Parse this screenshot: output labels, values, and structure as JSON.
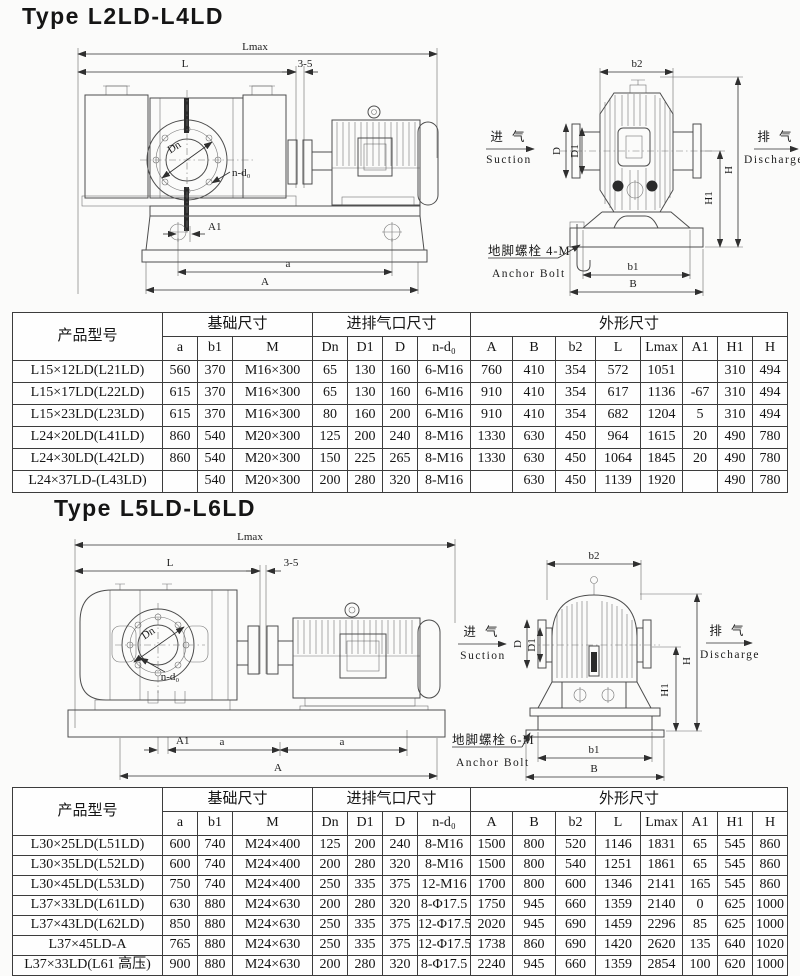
{
  "page": {
    "background": "#fbfbfa",
    "ink": "#141414",
    "line_color": "#4d4d4d"
  },
  "section1": {
    "title": "Type L2LD-L4LD",
    "drawing": {
      "dim_lmax": "Lmax",
      "dim_l": "L",
      "dim_gap": "3-5",
      "dim_dn": "Dn",
      "dim_ndo": "n-d₀",
      "dim_a1": "A1",
      "dim_a": "a",
      "dim_A": "A",
      "dim_b2": "b2",
      "dim_d": "D",
      "dim_d1": "D1",
      "dim_h": "H",
      "dim_h1": "H1",
      "dim_b1": "b1",
      "dim_b": "B",
      "suction_cn": "进 气",
      "suction_en": "Suction",
      "discharge_cn": "排 气",
      "discharge_en": "Discharge",
      "anchor_cn": "地脚螺栓 4-M",
      "anchor_en": "Anchor Bolt"
    },
    "table": {
      "headers": {
        "model": "产品型号",
        "base": "基础尺寸",
        "port": "进排气口尺寸",
        "outline": "外形尺寸",
        "sub": [
          "a",
          "b1",
          "M",
          "Dn",
          "D1",
          "D",
          "n-d₀",
          "A",
          "B",
          "b2",
          "L",
          "Lmax",
          "A1",
          "H1",
          "H"
        ]
      },
      "rows": [
        [
          "L15×12LD(L21LD)",
          "560",
          "370",
          "M16×300",
          "65",
          "130",
          "160",
          "6-M16",
          "760",
          "410",
          "354",
          "572",
          "1051",
          "",
          "310",
          "494"
        ],
        [
          "L15×17LD(L22LD)",
          "615",
          "370",
          "M16×300",
          "65",
          "130",
          "160",
          "6-M16",
          "910",
          "410",
          "354",
          "617",
          "1136",
          "-67",
          "310",
          "494"
        ],
        [
          "L15×23LD(L23LD)",
          "615",
          "370",
          "M16×300",
          "80",
          "160",
          "200",
          "6-M16",
          "910",
          "410",
          "354",
          "682",
          "1204",
          "5",
          "310",
          "494"
        ],
        [
          "L24×20LD(L41LD)",
          "860",
          "540",
          "M20×300",
          "125",
          "200",
          "240",
          "8-M16",
          "1330",
          "630",
          "450",
          "964",
          "1615",
          "20",
          "490",
          "780"
        ],
        [
          "L24×30LD(L42LD)",
          "860",
          "540",
          "M20×300",
          "150",
          "225",
          "265",
          "8-M16",
          "1330",
          "630",
          "450",
          "1064",
          "1845",
          "20",
          "490",
          "780"
        ],
        [
          "L24×37LD-(L43LD)",
          "",
          "540",
          "M20×300",
          "200",
          "280",
          "320",
          "8-M16",
          "",
          "630",
          "450",
          "1139",
          "1920",
          "",
          "490",
          "780"
        ]
      ]
    }
  },
  "section2": {
    "title": "Type L5LD-L6LD",
    "drawing": {
      "dim_lmax": "Lmax",
      "dim_l": "L",
      "dim_gap": "3-5",
      "dim_dn": "Dn",
      "dim_ndo": "n-d₀",
      "dim_a1": "A1",
      "dim_a": "a",
      "dim_A": "A",
      "dim_b2": "b2",
      "dim_d": "D",
      "dim_d1": "D1",
      "dim_h": "H",
      "dim_h1": "H1",
      "dim_b1": "b1",
      "dim_b": "B",
      "suction_cn": "进 气",
      "suction_en": "Suction",
      "discharge_cn": "排 气",
      "discharge_en": "Discharge",
      "anchor_cn": "地脚螺栓 6-M",
      "anchor_en": "Anchor Bolt"
    },
    "table": {
      "headers": {
        "model": "产品型号",
        "base": "基础尺寸",
        "port": "进排气口尺寸",
        "outline": "外形尺寸",
        "sub": [
          "a",
          "b1",
          "M",
          "Dn",
          "D1",
          "D",
          "n-d₀",
          "A",
          "B",
          "b2",
          "L",
          "Lmax",
          "A1",
          "H1",
          "H"
        ]
      },
      "rows": [
        [
          "L30×25LD(L51LD)",
          "600",
          "740",
          "M24×400",
          "125",
          "200",
          "240",
          "8-M16",
          "1500",
          "800",
          "520",
          "1146",
          "1831",
          "65",
          "545",
          "860"
        ],
        [
          "L30×35LD(L52LD)",
          "600",
          "740",
          "M24×400",
          "200",
          "280",
          "320",
          "8-M16",
          "1500",
          "800",
          "540",
          "1251",
          "1861",
          "65",
          "545",
          "860"
        ],
        [
          "L30×45LD(L53LD)",
          "750",
          "740",
          "M24×400",
          "250",
          "335",
          "375",
          "12-M16",
          "1700",
          "800",
          "600",
          "1346",
          "2141",
          "165",
          "545",
          "860"
        ],
        [
          "L37×33LD(L61LD)",
          "630",
          "880",
          "M24×630",
          "200",
          "280",
          "320",
          "8-Φ17.5",
          "1750",
          "945",
          "660",
          "1359",
          "2140",
          "0",
          "625",
          "1000"
        ],
        [
          "L37×43LD(L62LD)",
          "850",
          "880",
          "M24×630",
          "250",
          "335",
          "375",
          "12-Φ17.5",
          "2020",
          "945",
          "690",
          "1459",
          "2296",
          "85",
          "625",
          "1000"
        ],
        [
          "L37×45LD-A",
          "765",
          "880",
          "M24×630",
          "250",
          "335",
          "375",
          "12-Φ17.5",
          "1738",
          "860",
          "690",
          "1420",
          "2620",
          "135",
          "640",
          "1020"
        ],
        [
          "L37×33LD(L61 高压)",
          "900",
          "880",
          "M24×630",
          "200",
          "280",
          "320",
          "8-Φ17.5",
          "2240",
          "945",
          "660",
          "1359",
          "2854",
          "100",
          "620",
          "1000"
        ]
      ]
    }
  }
}
